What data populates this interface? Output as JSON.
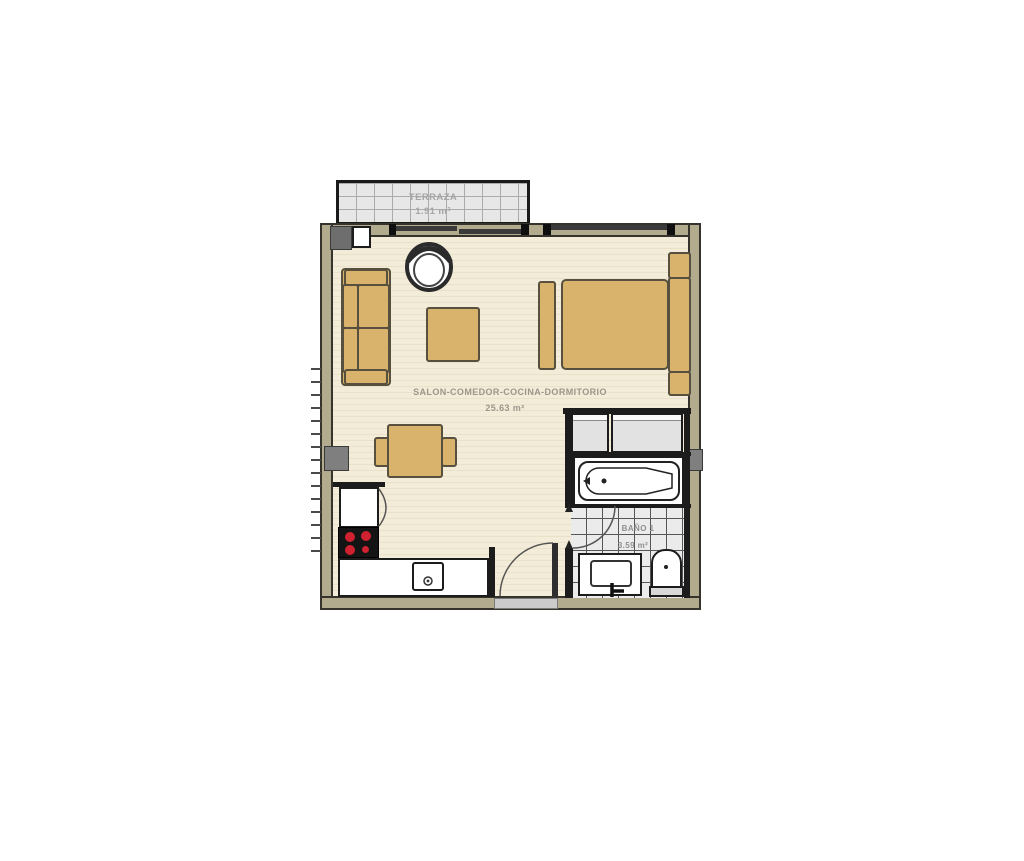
{
  "rooms": {
    "terrace": {
      "name": "TERRAZA",
      "area": "1.91 m²"
    },
    "main": {
      "name": "SALON-COMEDOR-COCINA-DORMITORIO",
      "area": "25.63 m²"
    },
    "bathroom": {
      "name": "BAÑO 1",
      "area": "3.59 m²"
    }
  },
  "colors": {
    "background": "#ffffff",
    "wall_fill": "#b3ab8e",
    "wall_outline": "#35332c",
    "interior_wall": "#1c1c1c",
    "floor": "#f3ecd8",
    "floor_stripe": "#eae1ca",
    "furniture": "#d9b36b",
    "furniture_outline": "#57503e",
    "terrace_tile": "#e7e7e7",
    "terrace_grid": "#ababab",
    "bath_tile": "#ebebeb",
    "bath_grid": "#565656",
    "wardrobe": "#e2e2e2",
    "window_glass": "#3a3a3a",
    "column": "#7f7f7f",
    "stove_burner": "#cf2130",
    "label_main": "#9c968b",
    "label_terrace": "#a6a6a6",
    "label_bath": "#8f8f8f"
  }
}
